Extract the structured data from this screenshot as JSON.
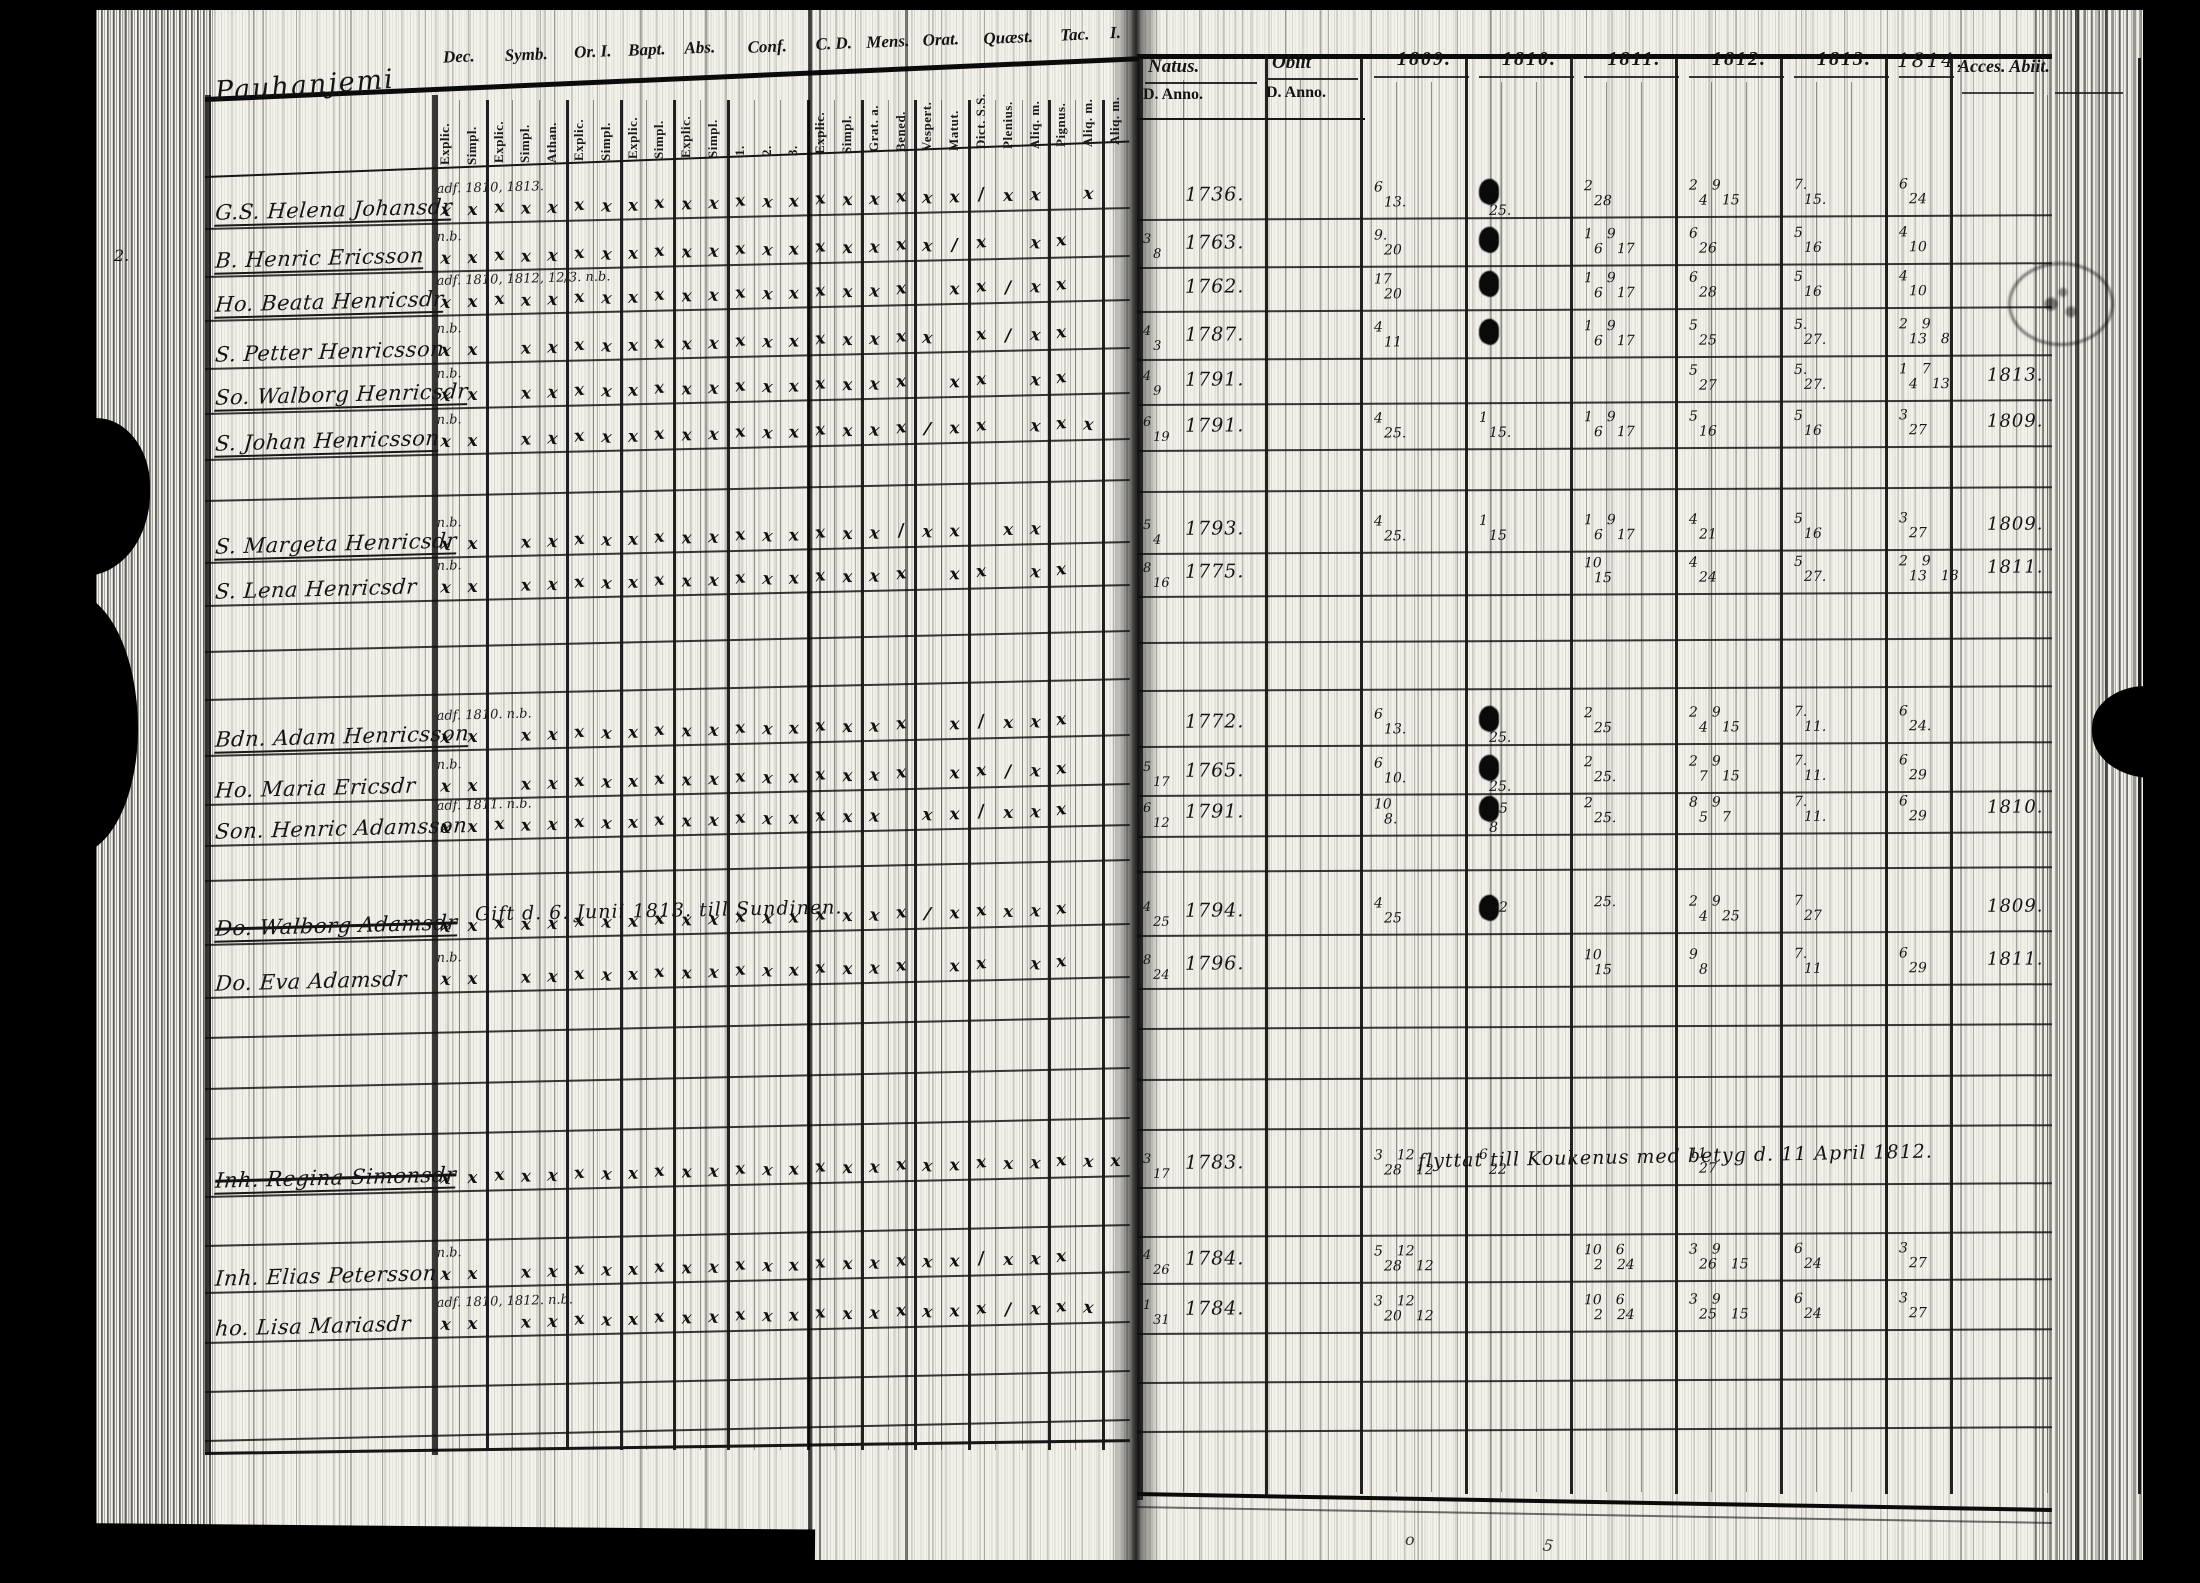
{
  "document": {
    "type_label": "communion-book-scan",
    "placename": "Pauhanjemi",
    "ink_color": "#141414",
    "paper_color": "#f3f1ea"
  },
  "left_table": {
    "placename": "Pauhanjemi",
    "column_groups": [
      {
        "label": "Dec.",
        "subs": [
          "Explic.",
          "Simpl."
        ]
      },
      {
        "label": "Symb.",
        "subs": [
          "Explic.",
          "Simpl.",
          "Athan."
        ]
      },
      {
        "label": "Or. I.",
        "subs": [
          "Explic.",
          "Simpl."
        ]
      },
      {
        "label": "Bapt.",
        "subs": [
          "Explic.",
          "Simpl."
        ]
      },
      {
        "label": "Abs.",
        "subs": [
          "Explic.",
          "Simpl."
        ]
      },
      {
        "label": "Conf.",
        "subs": [
          "1.",
          "2.",
          "3."
        ]
      },
      {
        "label": "C. D.",
        "subs": [
          "Explic.",
          "Simpl."
        ]
      },
      {
        "label": "Mens.",
        "subs": [
          "Grat. a.",
          "Bened."
        ]
      },
      {
        "label": "Orat.",
        "subs": [
          "Vespert.",
          "Matut."
        ]
      },
      {
        "label": "Quæst.",
        "subs": [
          "Dict. S.S.",
          "Plenius.",
          "Aliq. m."
        ]
      },
      {
        "label": "Tac.",
        "subs": [
          "Pignus.",
          "Aliq. m."
        ]
      },
      {
        "label": "I.",
        "subs": [
          "Aliq. m."
        ]
      }
    ],
    "rows": [
      {
        "name": "G.S. Helena Johansdr",
        "note": "adf. 1810, 1813.",
        "underline": true,
        "strike": false,
        "marks": "x,x,x,x,x,x,x,x,x,x,x,x,x,x,x,x,x,x,x,x,/,x,x,,x,"
      },
      {
        "name": "B. Henric Ericsson",
        "note": "n.b.",
        "underline": true,
        "strike": false,
        "marks": "x,x,x,x,x,x,x,x,x,x,x,x,x,x,x,x,x,x,x,/,x,,x,x,,"
      },
      {
        "name": "Ho. Beata Henricsdr",
        "note": "adf. 1810, 1812, 12/3. n.b.",
        "underline": true,
        "strike": false,
        "marks": "x,x,x,x,x,x,x,x,x,x,x,x,x,x,x,x,x,x,,x,x,/,x,x,,"
      },
      {
        "name": "S. Petter Henricsson",
        "note": "n.b.",
        "underline": false,
        "strike": false,
        "marks": "x,x,,x,x,x,x,x,x,x,x,x,x,x,x,x,x,x,x,,x,/,x,x,,"
      },
      {
        "name": "So. Walborg Henricsdr",
        "note": "n.b.",
        "underline": true,
        "strike": false,
        "marks": "x,x,,x,x,x,x,x,x,x,x,x,x,x,x,x,x,x,,x,x,,x,x,,"
      },
      {
        "name": "S. Johan Henricsson",
        "note": "n.b.",
        "underline": true,
        "strike": false,
        "marks": "x,x,,x,x,x,x,x,x,x,x,x,x,x,x,x,x,x,/,x,x,,x,x,x,"
      },
      {
        "name": "S. Margeta Henricsdr",
        "note": "n.b.",
        "underline": true,
        "strike": false,
        "marks": "x,x,,x,x,x,x,x,x,x,x,x,x,x,x,x,x,/,x,x,,x,x,,,"
      },
      {
        "name": "S. Lena Henricsdr",
        "note": "n.b.",
        "underline": false,
        "strike": false,
        "marks": "x,x,,x,x,x,x,x,x,x,x,x,x,x,x,x,x,x,,x,x,,x,x,,"
      },
      {
        "name": "Bdn. Adam Henricsson",
        "note": "adf. 1810. n.b.",
        "underline": true,
        "strike": false,
        "marks": "x,x,,x,x,x,x,x,x,x,x,x,x,x,x,x,x,x,,x,/,x,x,x,,"
      },
      {
        "name": "Ho. Maria Ericsdr",
        "note": "n.b.",
        "underline": false,
        "strike": false,
        "marks": "x,x,,x,x,x,x,x,x,x,x,x,x,x,x,x,x,x,,x,x,/,x,x,,"
      },
      {
        "name": "Son. Henric Adamsson",
        "note": "adf. 1811. n.b.",
        "underline": false,
        "strike": false,
        "marks": "x,x,x,x,x,x,x,x,x,x,x,x,x,x,x,x,x,,x,x,/,x,x,x,,"
      },
      {
        "name": "Do. Walborg Adamsdr",
        "note": "",
        "underline": true,
        "strike": true,
        "marks": "x,x,x,x,x,x,x,x,x,x,x,x,x,x,x,x,x,x,/,x,x,x,x,x,,"
      },
      {
        "name": "Do. Eva Adamsdr",
        "note": "n.b.",
        "underline": false,
        "strike": false,
        "marks": "x,x,,x,x,x,x,x,x,x,x,x,x,x,x,x,x,x,,x,x,,x,x,,"
      },
      {
        "name": "Inh. Regina Simonsdr",
        "note": "",
        "underline": true,
        "strike": true,
        "marks": "x,x,x,x,x,x,x,x,x,x,x,x,x,x,x,x,x,x,x,x,x,x,x,x,x,x"
      },
      {
        "name": "Inh. Elias Petersson",
        "note": "n.b.",
        "underline": false,
        "strike": false,
        "marks": "x,x,,x,x,x,x,x,x,x,x,x,x,x,x,x,x,x,x,x,/,x,x,x,,"
      },
      {
        "name": "ho. Lisa Mariasdr",
        "note": "adf. 1810, 1812. n.b.",
        "underline": false,
        "strike": false,
        "marks": "x,x,,x,x,x,x,x,x,x,x,x,x,x,x,x,x,x,x,x,x,/,x,x,x,"
      }
    ],
    "gift_note": "Gift d. 6. Junii 1813. till Sundinen.",
    "marginalia": [
      "2.",
      "2."
    ]
  },
  "right_table": {
    "headers": {
      "natus": "Natus.",
      "obiit": "Obiit",
      "d_anno": "D. Anno.",
      "years": [
        "1809.",
        "1810.",
        "1811.",
        "1812.",
        "1813.",
        "1814."
      ],
      "acces_abiit": "Acces. Abiit."
    },
    "moved_note": "flyttat till Koukenus med betyg d. 11 April 1812.",
    "rows": [
      {
        "natus_d": "",
        "natus_anno": "1736.",
        "obiit": "",
        "years": [
          "6|13.",
          "▚|25.",
          "2|28",
          "2 9|4 15",
          "7.|15.",
          "6|24"
        ],
        "abiit": ""
      },
      {
        "natus_d": "3|8",
        "natus_anno": "1763.",
        "obiit": "",
        "years": [
          "9.|20",
          "▚|",
          "1 9|6 17",
          "6|26",
          "5|16",
          "4|10"
        ],
        "abiit": ""
      },
      {
        "natus_d": "",
        "natus_anno": "1762.",
        "obiit": "",
        "years": [
          "17|20",
          "▚|",
          "1 9|6 17",
          "6|28",
          "5|16",
          "4|10"
        ],
        "abiit": ""
      },
      {
        "natus_d": "4|3",
        "natus_anno": "1787.",
        "obiit": "",
        "years": [
          "4|11",
          "▚|",
          "1 9|6 17",
          "5|25",
          "5.|27.",
          "2 9|13 8"
        ],
        "abiit": ""
      },
      {
        "natus_d": "4|9",
        "natus_anno": "1791.",
        "obiit": "",
        "years": [
          "|",
          "|",
          "|",
          "5|27",
          "5.|27.",
          "1 7|4 13"
        ],
        "abiit": "1813."
      },
      {
        "natus_d": "6|19",
        "natus_anno": "1791.",
        "obiit": "",
        "years": [
          "4|25.",
          "1|15.",
          "1 9|6 17",
          "5|16",
          "5|16",
          "3|27"
        ],
        "abiit": "1809."
      },
      {
        "natus_d": "5|4",
        "natus_anno": "1793.",
        "obiit": "",
        "years": [
          "4|25.",
          "1|15",
          "1 9|6 17",
          "4|21",
          "5|16",
          "3|27"
        ],
        "abiit": "1809."
      },
      {
        "natus_d": "8|16",
        "natus_anno": "1775.",
        "obiit": "",
        "years": [
          "|",
          "|",
          "10|15",
          "4|24",
          "5|27.",
          "2 9|13 18"
        ],
        "abiit": "1811."
      },
      {
        "natus_d": "",
        "natus_anno": "1772.",
        "obiit": "",
        "years": [
          "6|13.",
          "▚|25.",
          "2|25",
          "2 9|4 15",
          "7.|11.",
          "6|24."
        ],
        "abiit": ""
      },
      {
        "natus_d": "5|17",
        "natus_anno": "1765.",
        "obiit": "",
        "years": [
          "6|10.",
          "▚|25.",
          "2|25.",
          "2 9|7 15",
          "7.|11.",
          "6|29"
        ],
        "abiit": ""
      },
      {
        "natus_d": "6|12",
        "natus_anno": "1791.",
        "obiit": "",
        "years": [
          "10|8.",
          "▚5|8",
          "2|25.",
          "8 9|5 7",
          "7.|11.",
          "6|29"
        ],
        "abiit": "1810."
      },
      {
        "natus_d": "4|25",
        "natus_anno": "1794.",
        "obiit": "",
        "years": [
          "4|25",
          "▚2|",
          "|25.",
          "2 9|4 25",
          "7|27",
          ""
        ],
        "abiit": "1809."
      },
      {
        "natus_d": "8|24",
        "natus_anno": "1796.",
        "obiit": "",
        "years": [
          "|",
          "|",
          "10|15",
          "9|8",
          "7.|11",
          "6|29"
        ],
        "abiit": "1811."
      },
      {
        "natus_d": "3|17",
        "natus_anno": "1783.",
        "obiit": "",
        "years": [
          "3 12|28 12",
          "6|22",
          "|",
          "11|27",
          "",
          ""
        ],
        "abiit": ""
      },
      {
        "natus_d": "4|26",
        "natus_anno": "1784.",
        "obiit": "",
        "years": [
          "5 12|28 12",
          "",
          "10 6|2 24",
          "3 9|26 15",
          "6|24",
          "3|27"
        ],
        "abiit": ""
      },
      {
        "natus_d": "1|31",
        "natus_anno": "1784.",
        "obiit": "",
        "years": [
          "3 12|20 12",
          "",
          "10 6|2 24",
          "3 9|25 15",
          "6|24",
          "3|27"
        ],
        "abiit": ""
      }
    ]
  },
  "footer": {
    "gutter_mark": "o",
    "page_mark": "5"
  }
}
